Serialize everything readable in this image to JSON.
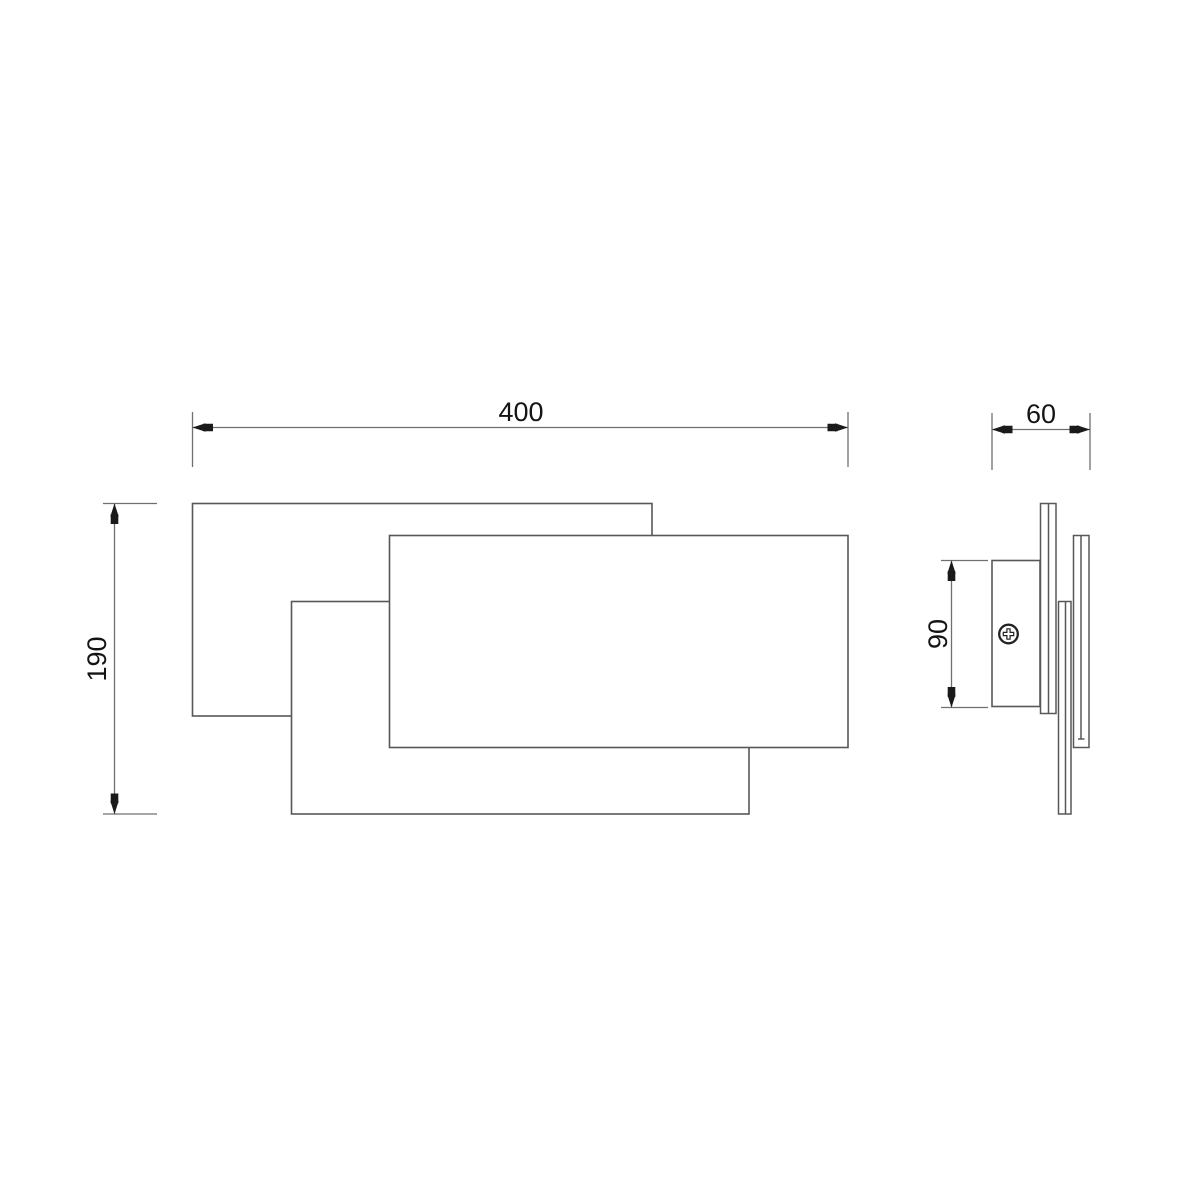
{
  "drawing": {
    "background_color": "#ffffff",
    "object_line_color": "#58585a",
    "dimension_line_color": "#6f6f6f",
    "text_color": "#141414",
    "arrow_color": "#1a1a1a",
    "icons": {
      "screw": "phillips-screw-icon"
    },
    "views": {
      "front": {
        "name": "front view",
        "dimensions": {
          "width": "400",
          "height": "190"
        }
      },
      "side": {
        "name": "side view",
        "dimensions": {
          "depth": "60",
          "bracket_height": "90"
        }
      }
    }
  }
}
